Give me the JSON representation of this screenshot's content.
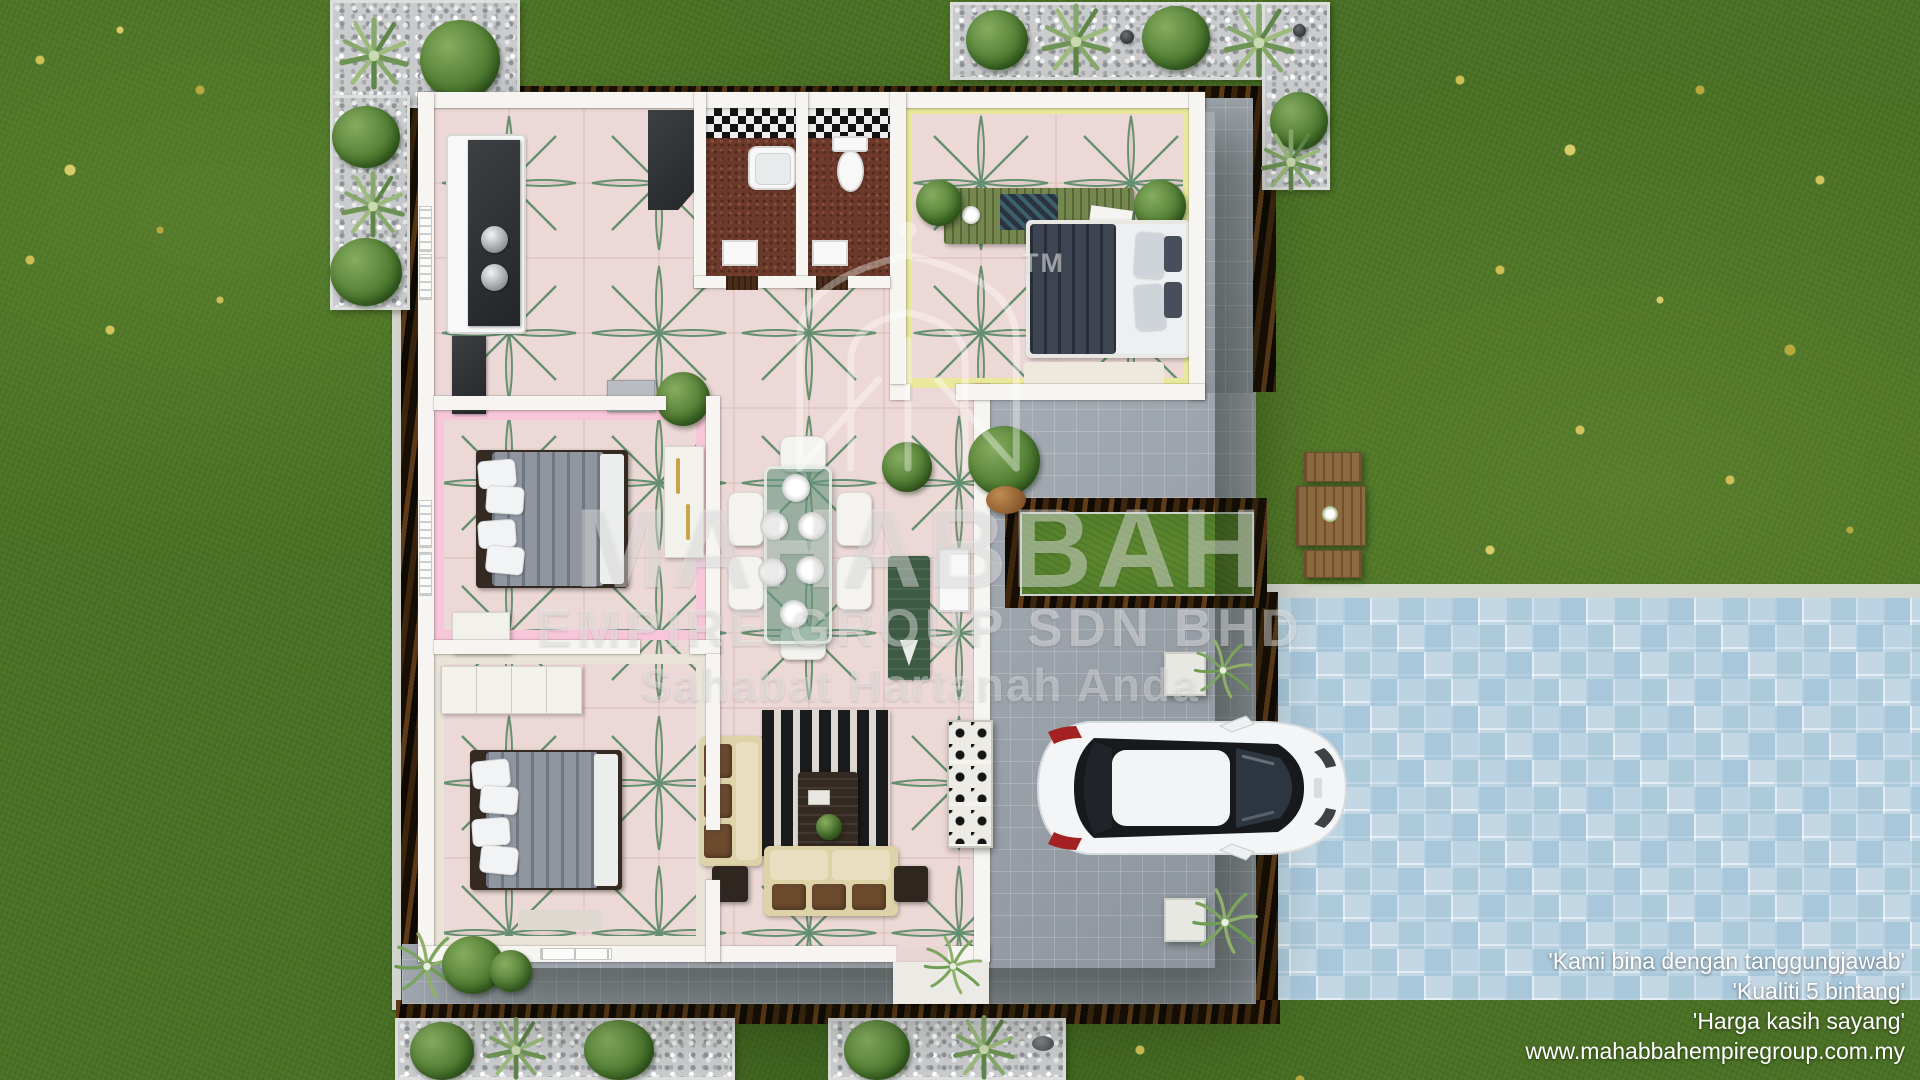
{
  "watermark": {
    "trademark": "TM",
    "brand": "MAHABBAH",
    "brand_line2": "EMPIRE GROUP SDN BHD",
    "slogan": "Sahabat Hartanah Anda"
  },
  "footer": {
    "tagline1": "'Kami bina dengan tanggungjawab'",
    "tagline2": "'Kualiti 5 bintang'",
    "tagline3": "'Harga kasih sayang'",
    "website": "www.mahabbahempiregroup.com.my"
  },
  "palette": {
    "grass": "#497023",
    "driveway_tile": "#c3d8e4",
    "patio_paver": "#9aa2ab",
    "floor_tile_pink": "#ecd8d6",
    "floor_motif_green": "#64906f",
    "wall_white": "#f6f5f1",
    "bedroom_pink": "#f7c6d9",
    "bedroom_yellow": "#eceb9e",
    "mulch_brown": "#231708",
    "gravel_grey": "#c9cbcd"
  }
}
